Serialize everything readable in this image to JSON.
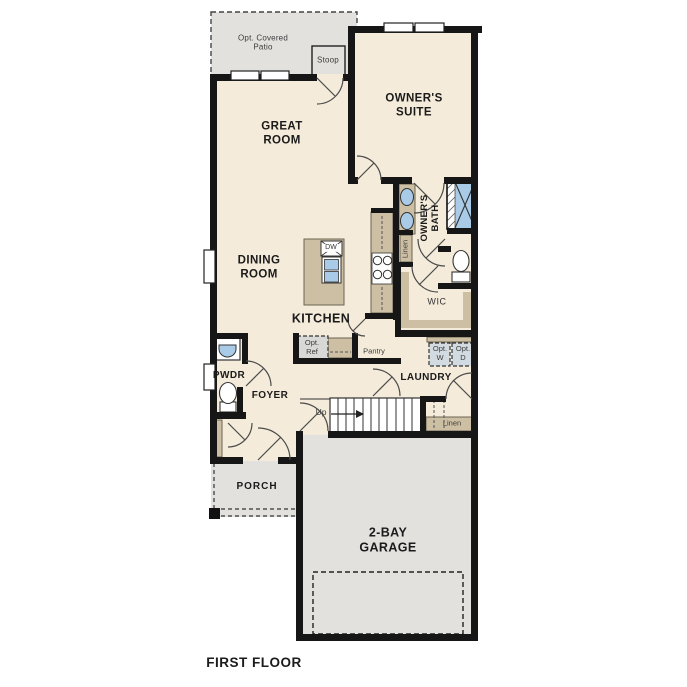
{
  "plan_title": "FIRST FLOOR",
  "rooms": {
    "patio": [
      "Opt. Covered",
      "Patio"
    ],
    "stoop": [
      "Stoop"
    ],
    "owners_suite": [
      "OWNER'S",
      "SUITE"
    ],
    "great_room": [
      "GREAT",
      "ROOM"
    ],
    "dining_room": [
      "DINING",
      "ROOM"
    ],
    "owners_bath": [
      "OWNER'S",
      "BATH"
    ],
    "linen_bath": [
      "Linen"
    ],
    "wic": [
      "WIC"
    ],
    "kitchen": [
      "KITCHEN"
    ],
    "laundry": [
      "LAUNDRY"
    ],
    "pantry": [
      "Pantry"
    ],
    "pwdr": [
      "PWDR"
    ],
    "foyer": [
      "FOYER"
    ],
    "porch": [
      "PORCH"
    ],
    "garage": [
      "2-BAY",
      "GARAGE"
    ],
    "linen_stairs": [
      "Linen"
    ]
  },
  "fixtures": {
    "dishwasher": "DW",
    "opt_ref": [
      "Opt.",
      "Ref"
    ],
    "opt_washer": [
      "Opt.",
      "W"
    ],
    "opt_dryer": [
      "Opt.",
      "D"
    ],
    "stairs_up": "Up"
  },
  "colors": {
    "floor_cream": "#f4ebda",
    "outdoor_gray": "#e2e1de",
    "cabinet_tan": "#cdbfa3",
    "fixture_blue": "#a9cbe7",
    "wall_black": "#161616",
    "optional_box_gray": "#d8d8d6",
    "optional_appliance_gray": "#d2dbe1"
  }
}
